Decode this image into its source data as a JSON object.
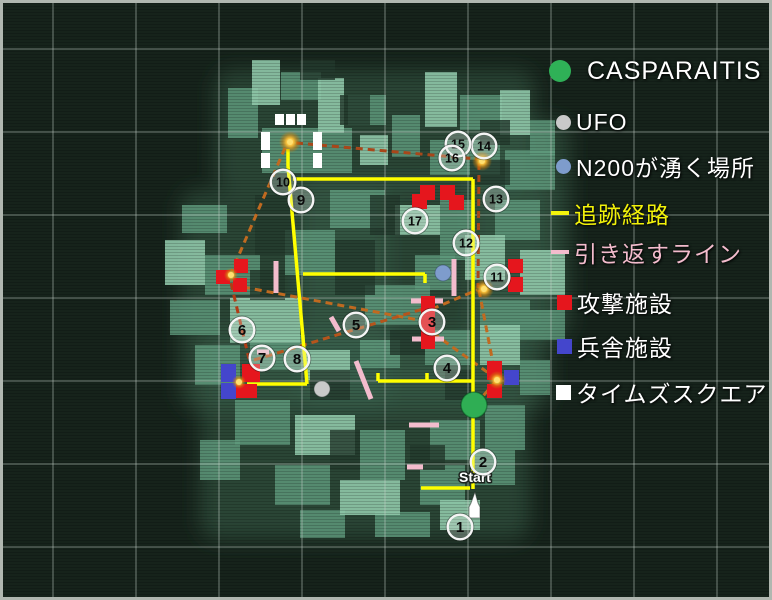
{
  "legend": {
    "items": [
      {
        "id": "casparaitis",
        "marker": "circle",
        "color": "#2fb157",
        "label": "CASPARAITIS",
        "label_color": "#ffffff",
        "x": 549,
        "y": 71
      },
      {
        "id": "ufo",
        "marker": "circle",
        "color": "#c9c9c9",
        "label": "UFO",
        "label_color": "#ffffff",
        "x": 556,
        "y": 122
      },
      {
        "id": "n200-spawn",
        "marker": "circle",
        "color": "#7e9ccc",
        "label": "N200が湧く場所",
        "label_color": "#ffffff",
        "x": 556,
        "y": 166
      },
      {
        "id": "tracking-route",
        "marker": "dash",
        "color": "#f4f40c",
        "label": "追跡経路",
        "label_color": "#f2f20a",
        "x": 551,
        "y": 213
      },
      {
        "id": "turn-back-line",
        "marker": "dash",
        "color": "#f3bccd",
        "label": "引き返すライン",
        "label_color": "#f3bccd",
        "x": 551,
        "y": 252
      },
      {
        "id": "attack-facility",
        "marker": "square",
        "color": "#e5161d",
        "label": "攻撃施設",
        "label_color": "#ffffff",
        "x": 557,
        "y": 302
      },
      {
        "id": "barracks-facility",
        "marker": "square",
        "color": "#4446cc",
        "label": "兵舎施設",
        "label_color": "#ffffff",
        "x": 557,
        "y": 346
      },
      {
        "id": "times-square",
        "marker": "square",
        "color": "#ffffff",
        "label": "タイムズスクエア",
        "label_color": "#ffffff",
        "x": 556,
        "y": 392
      }
    ]
  },
  "map": {
    "start_label": "Start",
    "waypoints": [
      {
        "n": 1,
        "x": 460,
        "y": 527
      },
      {
        "n": 2,
        "x": 483,
        "y": 462
      },
      {
        "n": 3,
        "x": 432,
        "y": 322
      },
      {
        "n": 4,
        "x": 447,
        "y": 368
      },
      {
        "n": 5,
        "x": 356,
        "y": 325
      },
      {
        "n": 6,
        "x": 242,
        "y": 330
      },
      {
        "n": 7,
        "x": 262,
        "y": 358
      },
      {
        "n": 8,
        "x": 297,
        "y": 359
      },
      {
        "n": 9,
        "x": 301,
        "y": 200
      },
      {
        "n": 10,
        "x": 283,
        "y": 182
      },
      {
        "n": 11,
        "x": 497,
        "y": 277
      },
      {
        "n": 12,
        "x": 466,
        "y": 243
      },
      {
        "n": 13,
        "x": 496,
        "y": 199
      },
      {
        "n": 14,
        "x": 484,
        "y": 146
      },
      {
        "n": 15,
        "x": 458,
        "y": 144
      },
      {
        "n": 16,
        "x": 452,
        "y": 158
      },
      {
        "n": 17,
        "x": 415,
        "y": 221
      }
    ],
    "route_yellow_color": "#ffff00",
    "route_yellow": [
      [
        288,
        149,
        288,
        166
      ],
      [
        288,
        166,
        307,
        384
      ],
      [
        293,
        179,
        473,
        179
      ],
      [
        473,
        179,
        473,
        489
      ],
      [
        247,
        384,
        307,
        384
      ],
      [
        303,
        274,
        425,
        274
      ],
      [
        425,
        274,
        425,
        283
      ],
      [
        378,
        381,
        473,
        381
      ],
      [
        378,
        373,
        378,
        381
      ],
      [
        427,
        373,
        427,
        381
      ],
      [
        421,
        488,
        470,
        488
      ]
    ],
    "route_orange": [
      [
        296,
        143,
        477,
        159,
        "#a8471a"
      ],
      [
        479,
        163,
        478,
        288,
        "#a8471a"
      ],
      [
        479,
        290,
        496,
        379,
        "#c06a20"
      ],
      [
        496,
        381,
        477,
        403,
        "#c06a20"
      ],
      [
        285,
        148,
        232,
        271,
        "#c06a20"
      ],
      [
        231,
        283,
        249,
        359,
        "#b03c16"
      ],
      [
        243,
        287,
        424,
        321,
        "#c06a20"
      ],
      [
        254,
        360,
        423,
        309,
        "#b5551c"
      ],
      [
        432,
        309,
        477,
        290,
        "#c06a20"
      ],
      [
        433,
        333,
        494,
        377,
        "#c06a20"
      ]
    ],
    "turn_back_color": "#f3bccd",
    "turn_back_pink": [
      [
        276,
        261,
        276,
        293
      ],
      [
        454,
        259,
        454,
        296
      ],
      [
        411,
        301,
        443,
        301
      ],
      [
        412,
        339,
        444,
        339
      ],
      [
        331,
        317,
        339,
        331
      ],
      [
        356,
        361,
        371,
        399
      ],
      [
        409,
        425,
        439,
        425
      ],
      [
        407,
        467,
        423,
        467
      ],
      [
        257,
        352,
        269,
        352
      ]
    ],
    "attack_color": "#e5161d",
    "attack_facilities": [
      [
        234,
        259,
        14,
        14
      ],
      [
        216,
        270,
        14,
        14
      ],
      [
        233,
        278,
        14,
        14
      ],
      [
        420,
        185,
        15,
        15
      ],
      [
        440,
        185,
        15,
        15
      ],
      [
        412,
        194,
        15,
        15
      ],
      [
        449,
        195,
        15,
        15
      ],
      [
        421,
        296,
        14,
        53
      ],
      [
        508,
        259,
        15,
        14
      ],
      [
        508,
        277,
        15,
        15
      ],
      [
        242,
        364,
        18,
        18
      ],
      [
        236,
        384,
        21,
        14
      ],
      [
        487,
        361,
        15,
        19
      ],
      [
        487,
        384,
        15,
        14
      ]
    ],
    "barracks_color": "#4446cc",
    "barracks_facilities": [
      [
        221,
        364,
        15,
        18
      ],
      [
        221,
        383,
        15,
        16
      ],
      [
        504,
        370,
        15,
        15
      ]
    ],
    "times_square_color": "#ffffff",
    "times_squares": [
      [
        275,
        114,
        9,
        11
      ],
      [
        286,
        114,
        9,
        11
      ],
      [
        297,
        114,
        9,
        11
      ],
      [
        261,
        132,
        9,
        18
      ],
      [
        261,
        153,
        9,
        15
      ],
      [
        313,
        132,
        9,
        18
      ],
      [
        313,
        153,
        9,
        15
      ]
    ],
    "glow_points": [
      [
        290,
        142,
        11
      ],
      [
        482,
        161,
        10
      ],
      [
        484,
        289,
        10
      ],
      [
        497,
        380,
        9
      ],
      [
        231,
        275,
        7
      ],
      [
        239,
        382,
        7
      ]
    ],
    "casparaitis_point": {
      "x": 474,
      "y": 405,
      "r": 13,
      "color": "#2fae54"
    },
    "ufo_point": {
      "x": 322,
      "y": 389,
      "r": 8,
      "color": "#c9c9c9"
    },
    "n200_point": {
      "x": 443,
      "y": 273,
      "r": 8,
      "color": "#7e9ccc"
    },
    "start": {
      "text_x": 475,
      "text_y": 482,
      "arrow": [
        [
          475,
          492
        ],
        [
          478,
          503
        ],
        [
          480,
          507
        ],
        [
          480,
          518
        ],
        [
          469,
          518
        ],
        [
          469,
          507
        ],
        [
          471,
          503
        ]
      ]
    },
    "grid": {
      "vx": [
        53,
        136,
        219,
        302,
        385,
        468,
        551,
        634,
        717
      ],
      "hy": [
        49,
        132,
        215,
        298,
        381,
        464,
        547
      ]
    },
    "buildings": {
      "blobs": [
        [
          215,
          70,
          320,
          120
        ],
        [
          180,
          190,
          210,
          220
        ],
        [
          300,
          180,
          250,
          230
        ],
        [
          200,
          330,
          330,
          210
        ],
        [
          470,
          120,
          100,
          220
        ]
      ],
      "bright": [
        [
          252,
          60,
          28,
          45
        ],
        [
          318,
          78,
          26,
          55
        ],
        [
          425,
          72,
          32,
          55
        ],
        [
          500,
          90,
          30,
          45
        ],
        [
          165,
          240,
          40,
          45
        ],
        [
          230,
          298,
          70,
          45
        ],
        [
          395,
          205,
          45,
          30
        ],
        [
          465,
          235,
          40,
          45
        ],
        [
          520,
          250,
          45,
          45
        ],
        [
          305,
          350,
          45,
          30
        ],
        [
          480,
          325,
          40,
          40
        ],
        [
          295,
          415,
          60,
          40
        ],
        [
          340,
          480,
          60,
          35
        ],
        [
          440,
          500,
          40,
          30
        ],
        [
          360,
          135,
          28,
          30
        ]
      ],
      "mid": [
        [
          281,
          72,
          40,
          28
        ],
        [
          228,
          88,
          30,
          50
        ],
        [
          348,
          95,
          38,
          30
        ],
        [
          460,
          95,
          42,
          35
        ],
        [
          392,
          115,
          28,
          42
        ],
        [
          530,
          120,
          25,
          35
        ],
        [
          262,
          128,
          90,
          45
        ],
        [
          430,
          140,
          70,
          35
        ],
        [
          505,
          150,
          50,
          40
        ],
        [
          182,
          205,
          45,
          28
        ],
        [
          205,
          255,
          55,
          40
        ],
        [
          170,
          300,
          50,
          35
        ],
        [
          195,
          345,
          45,
          40
        ],
        [
          285,
          230,
          50,
          45
        ],
        [
          330,
          190,
          55,
          38
        ],
        [
          365,
          285,
          65,
          40
        ],
        [
          440,
          200,
          35,
          60
        ],
        [
          415,
          255,
          40,
          35
        ],
        [
          495,
          200,
          45,
          40
        ],
        [
          480,
          300,
          50,
          40
        ],
        [
          530,
          310,
          35,
          30
        ],
        [
          250,
          335,
          55,
          35
        ],
        [
          360,
          340,
          40,
          28
        ],
        [
          425,
          330,
          45,
          35
        ],
        [
          235,
          400,
          55,
          45
        ],
        [
          360,
          430,
          45,
          50
        ],
        [
          430,
          420,
          50,
          40
        ],
        [
          485,
          405,
          40,
          45
        ],
        [
          275,
          465,
          55,
          40
        ],
        [
          420,
          465,
          45,
          40
        ],
        [
          475,
          450,
          40,
          35
        ],
        [
          300,
          510,
          45,
          28
        ],
        [
          375,
          512,
          55,
          25
        ],
        [
          520,
          360,
          30,
          35
        ],
        [
          200,
          440,
          40,
          40
        ]
      ],
      "dark": [
        [
          340,
          95,
          30,
          30
        ],
        [
          470,
          160,
          40,
          25
        ],
        [
          250,
          270,
          35,
          30
        ],
        [
          390,
          330,
          35,
          25
        ],
        [
          310,
          370,
          40,
          30
        ],
        [
          410,
          445,
          35,
          25
        ],
        [
          480,
          120,
          30,
          25
        ],
        [
          335,
          240,
          40,
          55
        ],
        [
          255,
          195,
          40,
          60
        ],
        [
          300,
          60,
          35,
          20
        ],
        [
          370,
          195,
          30,
          40
        ],
        [
          445,
          370,
          30,
          30
        ],
        [
          330,
          430,
          30,
          40
        ]
      ]
    }
  }
}
